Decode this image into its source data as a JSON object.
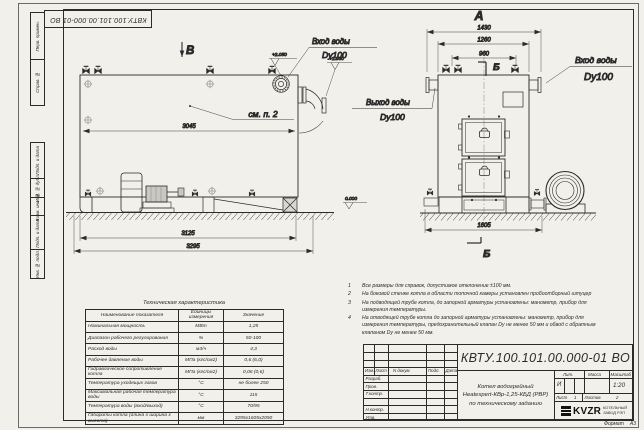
{
  "frame": {
    "stamp_top_rotated": "КВТУ.100.101.00.000-01  ВО",
    "format_label": "Формат",
    "format_value": "А3",
    "strip": [
      "Перв. примен.",
      "Справ. №",
      "Подп. и дата",
      "Инв. № дубл.",
      "Взам. инв. №",
      "Подп. и дата",
      "Инв. № подл."
    ]
  },
  "views": {
    "side": {
      "view_mark": "В",
      "callout": "см. п. 2",
      "dim_inner": "3045",
      "dim_body": "3125",
      "dim_overall": "3295",
      "level_top": "+2.050",
      "level_pipe": "+1.930",
      "inlet_label": "Вход воды",
      "inlet_dn": "Dy100"
    },
    "front": {
      "view_mark": "А",
      "section_mark_top": "Б",
      "section_mark_bottom": "Б",
      "dim_overall": "1430",
      "dim_body": "1260",
      "dim_valves": "960",
      "dim_base": "1605",
      "outlet_label": "Выход воды",
      "outlet_dn": "Dy100",
      "inlet_label": "Вход воды",
      "inlet_dn": "Dy100",
      "level_zero": "0.000"
    }
  },
  "notes": [
    {
      "n": "1",
      "text": "Все размеры для справок, допустимое отклонение ±100 мм."
    },
    {
      "n": "2",
      "text": "На боковой стенке котла в области топочной камеры установлен пробоотборный штуцер"
    },
    {
      "n": "3",
      "text": "На подводящей трубе котла, до запорной арматуры установлены: манометр, прибор для измерения температуры."
    },
    {
      "n": "4",
      "text": "На отводящей трубе котла до запорной арматуры установлены: манометр, прибор для измерения температуры, предохранительный клапан Dу не менее 50 мм и обвод с обратным клапаном Dу не менее 50 мм."
    }
  ],
  "tech_table": {
    "title": "Техническая характеристика",
    "headers": [
      "Наименование показателя",
      "Единицы измерения",
      "Значение"
    ],
    "rows": [
      [
        "Номинальная мощность",
        "МВт",
        "1,25"
      ],
      [
        "Диапазон рабочего регулирования",
        "%",
        "50-100"
      ],
      [
        "Расход воды",
        "м3/ч",
        "4,3"
      ],
      [
        "Рабочее давление воды",
        "МПа (кгс/см2)",
        "0,6 (6,0)"
      ],
      [
        "Гидравлическое сопротивление котла",
        "МПа (кгс/см2)",
        "0,06 (0,6)"
      ],
      [
        "Температура уходящих газов",
        "°С",
        "не более 250"
      ],
      [
        "Максимальная рабочая температура воды",
        "°С",
        "115"
      ],
      [
        "Температура воды (вход/выход)",
        "°С",
        "70/95"
      ],
      [
        "Габариты котла (длина х ширина х высота)",
        "мм",
        "3295х1605х2050"
      ]
    ]
  },
  "title_block": {
    "doc_number": "КВТУ.100.101.00.000-01 ВО",
    "product_line1": "Котел водогрейный",
    "product_line2": "Heatexpert-КВр-1,25-КБД (РВР)",
    "product_line3": "по техническому заданию",
    "header_cells": [
      "Изм.",
      "Лист",
      "N докум.",
      "Подп.",
      "Дата"
    ],
    "sig_rows": [
      "Разраб.",
      "Пров.",
      "Т.контр.",
      "",
      "Н.контр.",
      "Утв."
    ],
    "lit_label": "Лит.",
    "lit_value": "И",
    "mass_label": "Масса",
    "scale_label": "Масштаб",
    "scale_value": "1:20",
    "sheet_label": "Лист",
    "sheet_value": "1",
    "sheets_label": "Листов",
    "sheets_value": "2",
    "company_logo": "KVZR",
    "company_line1": "КОТЕЛЬНЫЙ",
    "company_line2": "ЗАВОД РЭП"
  }
}
